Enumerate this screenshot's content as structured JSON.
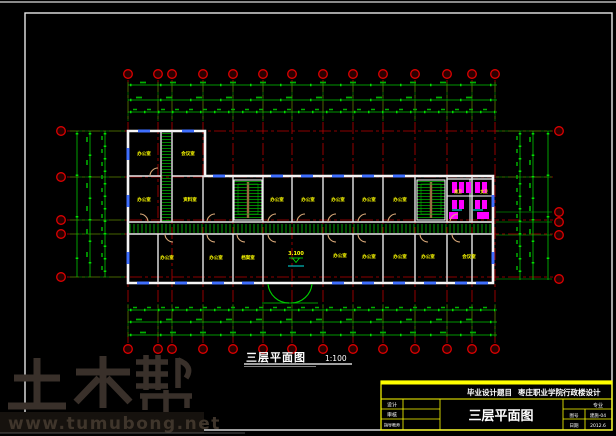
{
  "caption": {
    "title": "三层平面图",
    "scale": "1:100"
  },
  "title_block": {
    "header_label": "毕业设计题目",
    "header_value": "枣庄职业学院行政楼设计",
    "drawing_name": "三层平面图",
    "left_rows": [
      {
        "label": "设计",
        "value": ""
      },
      {
        "label": "审核",
        "value": ""
      },
      {
        "label": "指导教师",
        "value": ""
      }
    ],
    "right_rows": [
      {
        "label": "",
        "value": "专业"
      },
      {
        "label": "图号",
        "value": "建施-04"
      },
      {
        "label": "日期",
        "value": "2012.6"
      }
    ],
    "border_color": "#ffff00",
    "text_color": "#ffffff"
  },
  "watermark": {
    "logo": "土木帮",
    "url": "www.tumubong.net",
    "color": "#3a2f26"
  },
  "plan": {
    "elevation": "3.100",
    "toilet_labels": [
      {
        "label": "男卫"
      },
      {
        "label": "女卫"
      }
    ],
    "rooms": [
      {
        "label": "办公室"
      },
      {
        "label": "会议室"
      },
      {
        "label": "办公室"
      },
      {
        "label": "资料室"
      },
      {
        "label": "办公室"
      },
      {
        "label": "办公室"
      },
      {
        "label": "办公室"
      },
      {
        "label": "办公室"
      },
      {
        "label": "办公室"
      },
      {
        "label": "办公室"
      },
      {
        "label": "办公室"
      },
      {
        "label": "档案室"
      },
      {
        "label": "办公室"
      },
      {
        "label": "办公室"
      },
      {
        "label": "办公室"
      },
      {
        "label": "办公室"
      },
      {
        "label": "会议室"
      }
    ],
    "colors": {
      "axis_grid": "#bb0000",
      "bubble": "#dd0000",
      "dimension": "#00c800",
      "wall": "#f5f5f5",
      "window": "#3f6fff",
      "door": "#d8a878",
      "fixture": "#ff00ff",
      "room_label": "#ffff00",
      "hatch": "#00b000",
      "level_mark": "#00ee00"
    }
  }
}
